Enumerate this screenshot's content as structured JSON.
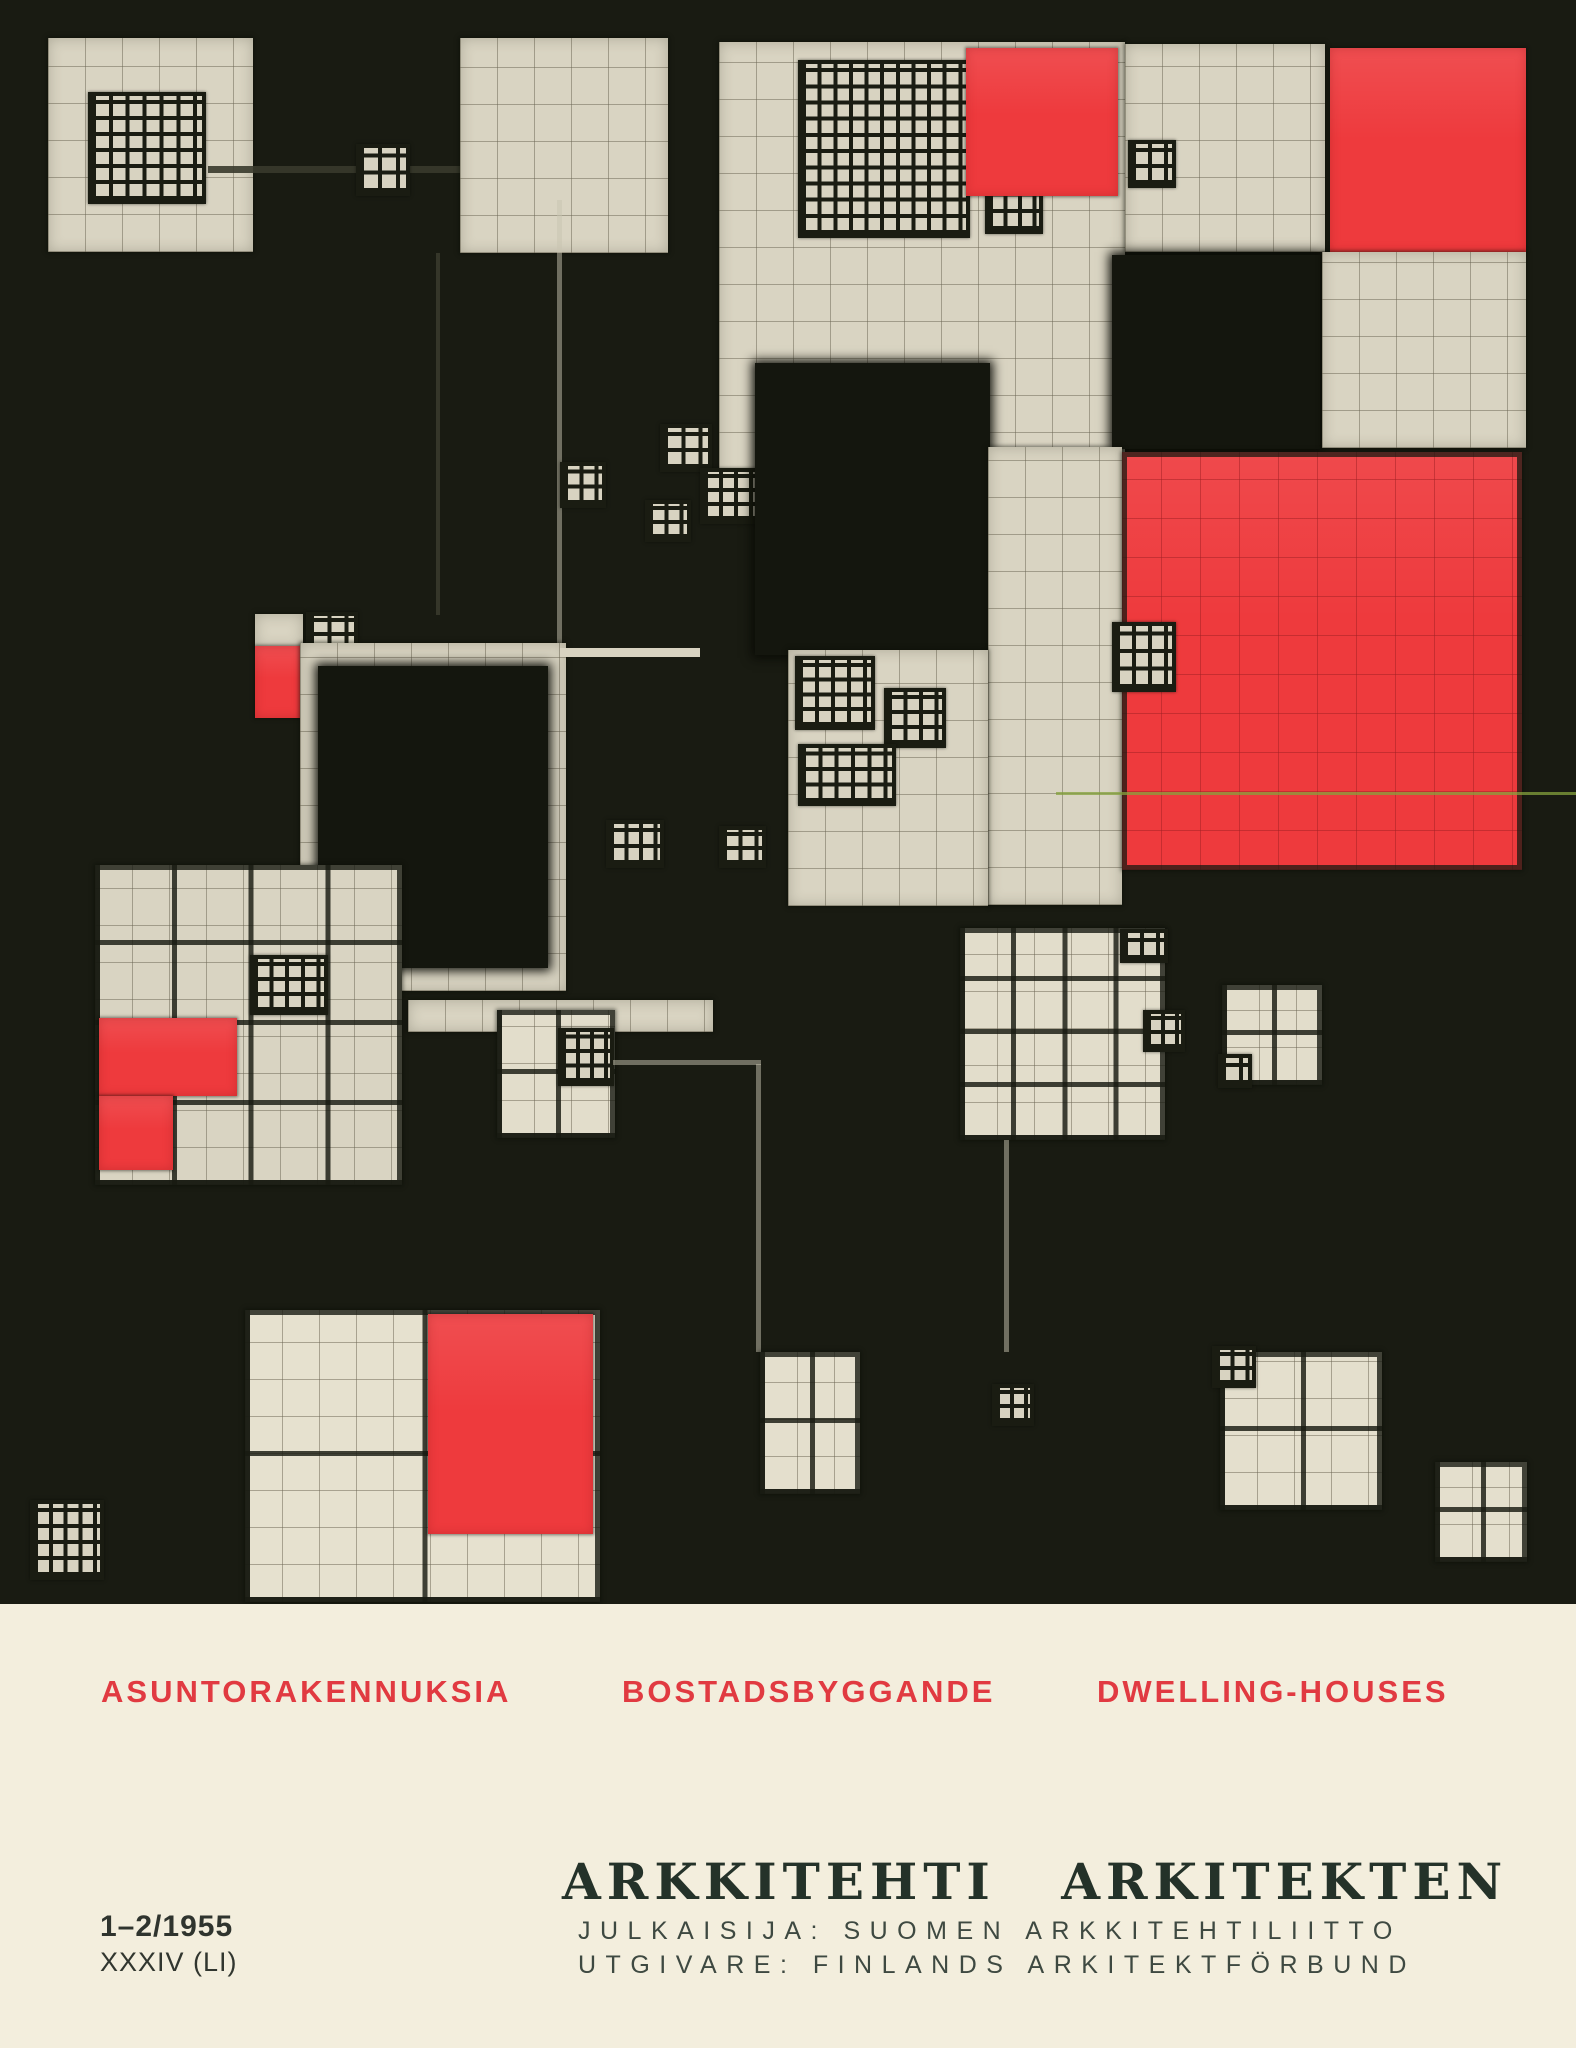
{
  "page": {
    "kind": "magazine-cover-scan",
    "width": 1576,
    "height": 2048
  },
  "palette": {
    "canvas_black": "#191b12",
    "paper_cream": "#d9d4c2",
    "page_cream": "#f3eedd",
    "accent_red": "#ee3a3d",
    "tagline_red": "#e13a41",
    "title_ink": "#243229",
    "body_ink": "#3e4941"
  },
  "artwork": {
    "background": "#191b12",
    "height": 1604,
    "blocks": [
      {
        "n": "top-left-grid-square",
        "t": "cream",
        "g": "fine",
        "x": 48,
        "y": 38,
        "w": 205,
        "h": 214
      },
      {
        "n": "top-left-doodle-grid",
        "t": "glyph",
        "x": 88,
        "y": 92,
        "w": 118,
        "h": 112
      },
      {
        "n": "top-connector-line",
        "t": "line",
        "c": "dark",
        "x": 208,
        "y": 166,
        "w": 255,
        "h": 7
      },
      {
        "n": "top-doodle-a",
        "t": "glyph",
        "x": 356,
        "y": 144,
        "w": 54,
        "h": 52
      },
      {
        "n": "top-doodle-b",
        "t": "glyph",
        "x": 468,
        "y": 146,
        "w": 46,
        "h": 48
      },
      {
        "n": "top-center-grid-square",
        "t": "cream",
        "g": "fine",
        "x": 460,
        "y": 38,
        "w": 208,
        "h": 215
      },
      {
        "n": "top-mid-grid-region",
        "t": "cream",
        "g": "fine",
        "x": 719,
        "y": 42,
        "w": 406,
        "h": 465
      },
      {
        "n": "top-mid-doodle-cluster",
        "t": "glyph",
        "x": 798,
        "y": 60,
        "w": 172,
        "h": 178
      },
      {
        "n": "top-mid-doodle-right",
        "t": "glyph",
        "x": 985,
        "y": 150,
        "w": 58,
        "h": 84
      },
      {
        "n": "top-red-square",
        "t": "red",
        "x": 966,
        "y": 48,
        "w": 152,
        "h": 148
      },
      {
        "n": "top-right-grid-square",
        "t": "cream",
        "g": "fine",
        "x": 1125,
        "y": 44,
        "w": 200,
        "h": 208
      },
      {
        "n": "top-right-doodle",
        "t": "glyph",
        "x": 1128,
        "y": 140,
        "w": 48,
        "h": 48
      },
      {
        "n": "top-right-red-square",
        "t": "red",
        "x": 1330,
        "y": 48,
        "w": 196,
        "h": 204
      },
      {
        "n": "right-black-square",
        "t": "black",
        "x": 1112,
        "y": 255,
        "w": 208,
        "h": 194
      },
      {
        "n": "right-grid-square",
        "t": "cream",
        "g": "fine",
        "x": 1322,
        "y": 252,
        "w": 204,
        "h": 196
      },
      {
        "n": "center-thin-vline",
        "t": "line",
        "c": "dim",
        "x": 557,
        "y": 200,
        "w": 5,
        "h": 448
      },
      {
        "n": "left-thin-vline",
        "t": "line",
        "c": "dark",
        "x": 436,
        "y": 253,
        "w": 4,
        "h": 362
      },
      {
        "n": "center-doodle-a",
        "t": "glyph",
        "x": 660,
        "y": 424,
        "w": 52,
        "h": 48
      },
      {
        "n": "center-doodle-b",
        "t": "glyph",
        "x": 700,
        "y": 468,
        "w": 60,
        "h": 56
      },
      {
        "n": "center-doodle-c",
        "t": "glyph",
        "x": 645,
        "y": 500,
        "w": 46,
        "h": 42
      },
      {
        "n": "center-doodle-d",
        "t": "glyph",
        "x": 560,
        "y": 462,
        "w": 46,
        "h": 46
      },
      {
        "n": "mid-black-block",
        "t": "black",
        "x": 755,
        "y": 363,
        "w": 235,
        "h": 292
      },
      {
        "n": "small-cream-cell",
        "t": "cream",
        "g": "none",
        "x": 255,
        "y": 614,
        "w": 48,
        "h": 34
      },
      {
        "n": "small-red-square",
        "t": "red",
        "x": 255,
        "y": 646,
        "w": 47,
        "h": 72
      },
      {
        "n": "small-doodle-near-red",
        "t": "glyph",
        "x": 306,
        "y": 612,
        "w": 52,
        "h": 42
      },
      {
        "n": "center-cream-frame",
        "t": "cream",
        "g": "fine",
        "x": 300,
        "y": 643,
        "w": 266,
        "h": 348
      },
      {
        "n": "center-frame-arm",
        "t": "line",
        "c": "cream",
        "x": 560,
        "y": 648,
        "w": 140,
        "h": 9
      },
      {
        "n": "center-black-square",
        "t": "black",
        "x": 318,
        "y": 666,
        "w": 230,
        "h": 302
      },
      {
        "n": "mid-right-cream-col",
        "t": "cream",
        "g": "fine",
        "x": 988,
        "y": 447,
        "w": 134,
        "h": 458
      },
      {
        "n": "mid-cream-block",
        "t": "cream",
        "g": "fine",
        "x": 788,
        "y": 650,
        "w": 200,
        "h": 256
      },
      {
        "n": "mid-doodle-a",
        "t": "glyph",
        "x": 795,
        "y": 656,
        "w": 80,
        "h": 74
      },
      {
        "n": "mid-doodle-b",
        "t": "glyph",
        "x": 884,
        "y": 688,
        "w": 62,
        "h": 60
      },
      {
        "n": "mid-doodle-c",
        "t": "glyph",
        "x": 798,
        "y": 744,
        "w": 98,
        "h": 62
      },
      {
        "n": "big-red-square",
        "t": "red",
        "g": "redgrid",
        "x": 1122,
        "y": 452,
        "w": 400,
        "h": 418
      },
      {
        "n": "red-edge-doodle",
        "t": "glyph",
        "x": 1112,
        "y": 622,
        "w": 64,
        "h": 70
      },
      {
        "n": "print-artifact-line",
        "t": "line",
        "c": "green",
        "x": 1056,
        "y": 792,
        "w": 520,
        "h": 3
      },
      {
        "n": "dark-doodle-a",
        "t": "glyph",
        "x": 606,
        "y": 820,
        "w": 58,
        "h": 48
      },
      {
        "n": "dark-doodle-b",
        "t": "glyph",
        "x": 719,
        "y": 826,
        "w": 47,
        "h": 42
      },
      {
        "n": "left-grid-square",
        "t": "cream",
        "g": "bold4",
        "x": 95,
        "y": 865,
        "w": 307,
        "h": 320
      },
      {
        "n": "left-square-doodle",
        "t": "glyph",
        "x": 250,
        "y": 955,
        "w": 78,
        "h": 60
      },
      {
        "n": "left-red-block-a",
        "t": "red",
        "x": 99,
        "y": 1018,
        "w": 138,
        "h": 78
      },
      {
        "n": "left-red-block-b",
        "t": "red",
        "x": 99,
        "y": 1096,
        "w": 74,
        "h": 74
      },
      {
        "n": "mid-strip",
        "t": "cream",
        "g": "fine",
        "x": 408,
        "y": 1000,
        "w": 305,
        "h": 32
      },
      {
        "n": "mid-grid-square",
        "t": "cream",
        "g": "bold2",
        "bg": "#e2ddcb",
        "x": 497,
        "y": 1010,
        "w": 118,
        "h": 128
      },
      {
        "n": "mid-square-doodle",
        "t": "glyph",
        "x": 558,
        "y": 1028,
        "w": 56,
        "h": 58
      },
      {
        "n": "right-center-grid-square",
        "t": "cream",
        "g": "bold4",
        "bg": "#e2ddcb",
        "x": 960,
        "y": 928,
        "w": 205,
        "h": 212
      },
      {
        "n": "rc-doodle-top",
        "t": "glyph",
        "x": 1120,
        "y": 929,
        "w": 48,
        "h": 34
      },
      {
        "n": "rc-doodle-side",
        "t": "glyph",
        "x": 1143,
        "y": 1010,
        "w": 42,
        "h": 42
      },
      {
        "n": "rc-small-grid-square",
        "t": "cream",
        "g": "bold2",
        "bg": "#e2ddcb",
        "x": 1222,
        "y": 985,
        "w": 100,
        "h": 100
      },
      {
        "n": "rc-small-doodle",
        "t": "glyph",
        "x": 1218,
        "y": 1054,
        "w": 34,
        "h": 34
      },
      {
        "n": "rc-thin-vline",
        "t": "line",
        "c": "dim",
        "x": 1004,
        "y": 1140,
        "w": 5,
        "h": 212
      },
      {
        "n": "mid-link-line",
        "t": "line",
        "c": "dim",
        "x": 613,
        "y": 1060,
        "w": 148,
        "h": 5
      },
      {
        "n": "bottom-thin-vline",
        "t": "line",
        "c": "dim",
        "x": 756,
        "y": 1064,
        "w": 5,
        "h": 288
      },
      {
        "n": "bottom-grid-square",
        "t": "cream",
        "g": "bold2",
        "bg": "#e6e1cf",
        "x": 245,
        "y": 1310,
        "w": 355,
        "h": 292
      },
      {
        "n": "bottom-red-cell",
        "t": "red",
        "x": 428,
        "y": 1314,
        "w": 165,
        "h": 220
      },
      {
        "n": "bottom-left-doodle",
        "t": "glyph",
        "x": 30,
        "y": 1500,
        "w": 74,
        "h": 80
      },
      {
        "n": "bottom-mid-grid-square",
        "t": "cream",
        "g": "bold2",
        "bg": "#e4dfcd",
        "x": 760,
        "y": 1352,
        "w": 100,
        "h": 142
      },
      {
        "n": "bottom-right-grid-square",
        "t": "cream",
        "g": "bold2",
        "bg": "#e4dfcd",
        "x": 1220,
        "y": 1352,
        "w": 162,
        "h": 158
      },
      {
        "n": "br-corner-doodle",
        "t": "glyph",
        "x": 1212,
        "y": 1346,
        "w": 44,
        "h": 42
      },
      {
        "n": "br-side-doodle",
        "t": "glyph",
        "x": 992,
        "y": 1384,
        "w": 42,
        "h": 42
      },
      {
        "n": "br-small-square",
        "t": "cream",
        "g": "bold2",
        "bg": "#e4dfcd",
        "x": 1435,
        "y": 1462,
        "w": 92,
        "h": 100
      }
    ]
  },
  "footer": {
    "taglines": [
      "ASUNTORAKENNUKSIA",
      "BOSTADSBYGGANDE",
      "DWELLING-HOUSES"
    ],
    "issue_number": "1–2/1955",
    "volume": "XXXIV (LI)",
    "title": "ARKKITEHTI ARKITEKTEN",
    "publisher_fi": "JULKAISIJA: SUOMEN ARKKITEHTILIITTO",
    "publisher_sv": "UTGIVARE: FINLANDS ARKITEKTFÖRBUND"
  }
}
